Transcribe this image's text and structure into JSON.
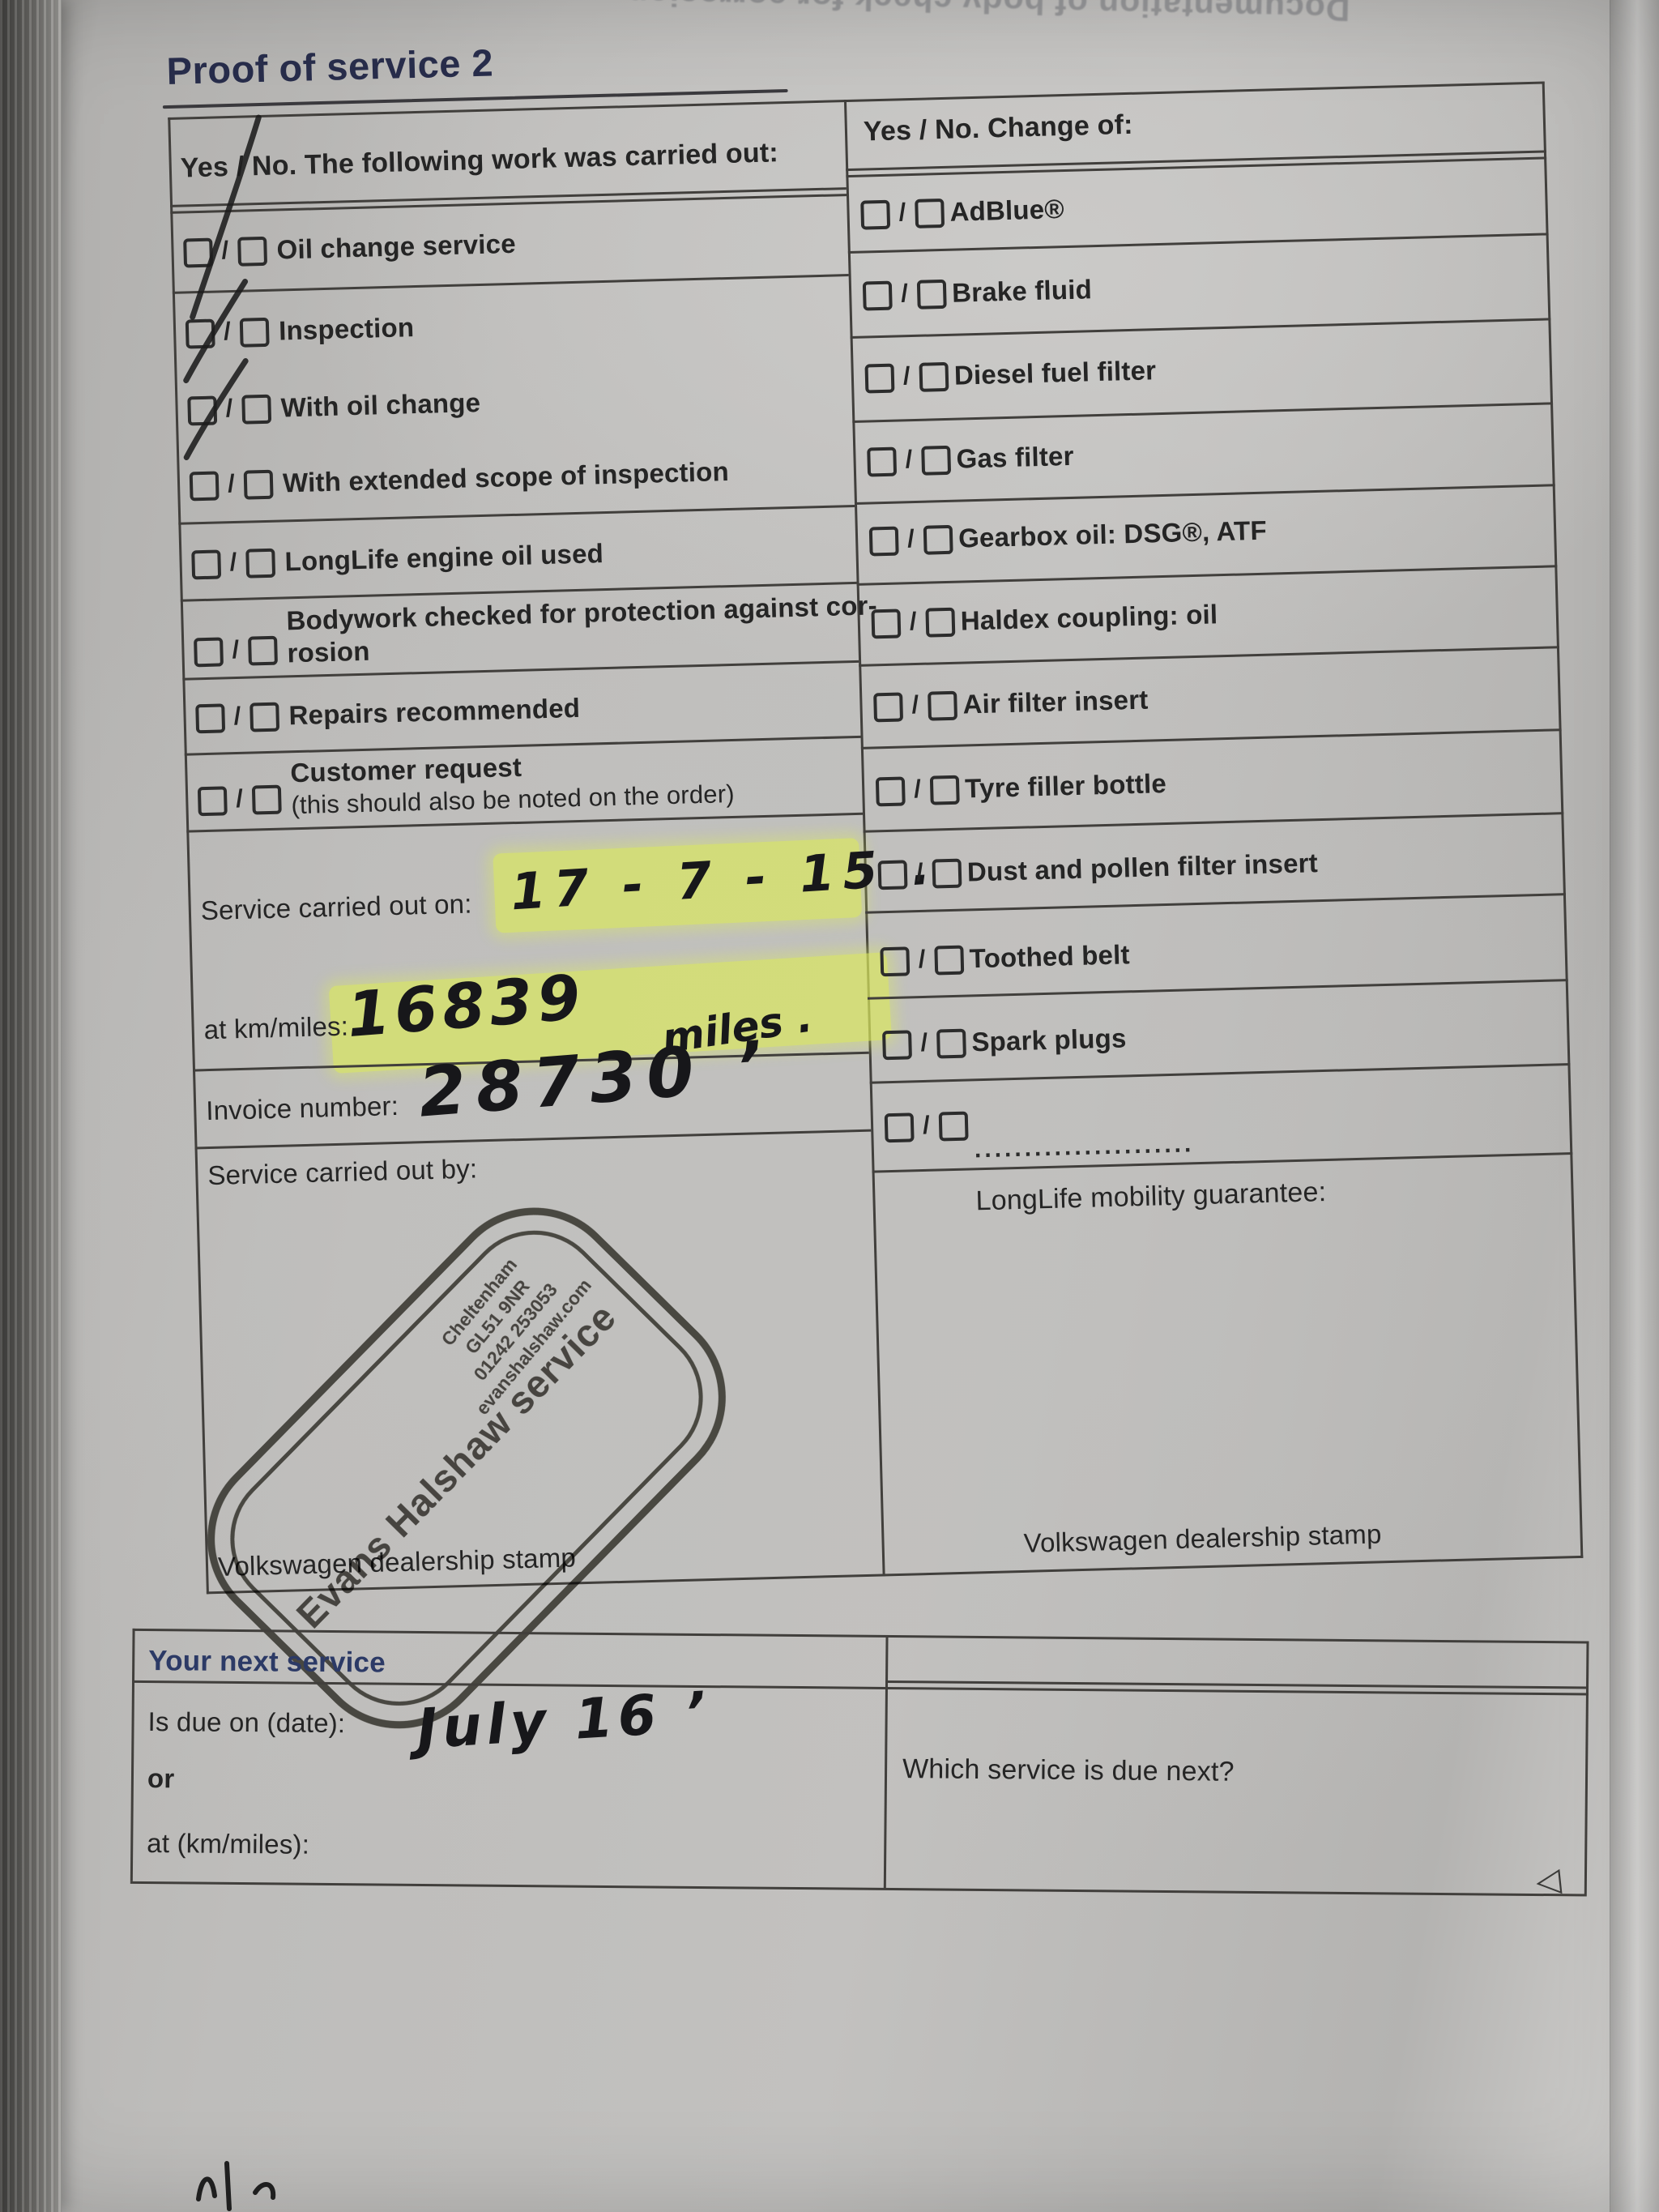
{
  "page": {
    "title": "Proof of service 2",
    "mirrored_top_text": "Documentation of body check for corrosion",
    "page_turn_arrow": "◁"
  },
  "ui": {
    "slash": "/"
  },
  "colors": {
    "accent_navy": "#2c3a66",
    "highlight": "#dbe95e",
    "ink": "#1f1f1f",
    "stamp_ink": "#38362f"
  },
  "work": {
    "header": "Yes / No. The following work was carried out:",
    "items": [
      {
        "label": "Oil change service",
        "yes": true
      },
      {
        "label": "Inspection",
        "yes": true
      },
      {
        "label": "With oil change",
        "yes": true
      },
      {
        "label": "With extended scope of inspection",
        "yes": false
      },
      {
        "label": "LongLife engine oil used",
        "yes": false
      },
      {
        "label": "Bodywork checked for protection against cor-",
        "label2": "rosion",
        "yes": false
      },
      {
        "label": "Repairs recommended",
        "yes": false
      },
      {
        "label": "Customer request",
        "label2": "(this should also be noted on the order)",
        "yes": false
      }
    ],
    "service_date_label": "Service carried out on:",
    "service_date_value": "17 - 7 - 15 .",
    "km_label": "at km/miles:",
    "km_value": "16839",
    "km_unit_note": "miles .",
    "invoice_label": "Invoice number:",
    "invoice_value": "28730 ’",
    "carried_out_by_label": "Service carried out by:",
    "stamp_caption": "Volkswagen dealership stamp"
  },
  "change": {
    "header": "Yes / No. Change of:",
    "items": [
      "AdBlue®",
      "Brake fluid",
      "Diesel fuel filter",
      "Gas filter",
      "Gearbox oil: DSG®, ATF",
      "Haldex coupling: oil",
      "Air filter insert",
      "Tyre filler bottle",
      "Dust and pollen filter insert",
      "Toothed belt",
      "Spark plugs"
    ],
    "blank_item_dots": "......................",
    "longlife_caption": "LongLife mobility guarantee:",
    "stamp_caption": "Volkswagen dealership stamp"
  },
  "stamp": {
    "line1": "Evans Halshaw service",
    "line2": "Cheltenham",
    "line3": "GL51 9NR",
    "line4": "01242 253053",
    "line5": "evanshalshaw.com"
  },
  "next_service": {
    "title": "Your next service",
    "due_date_label": "Is due on (date):",
    "due_date_value": "July 16 ’",
    "or_label": "or",
    "km_label": "at (km/miles):",
    "which_label": "Which service is due next?"
  }
}
